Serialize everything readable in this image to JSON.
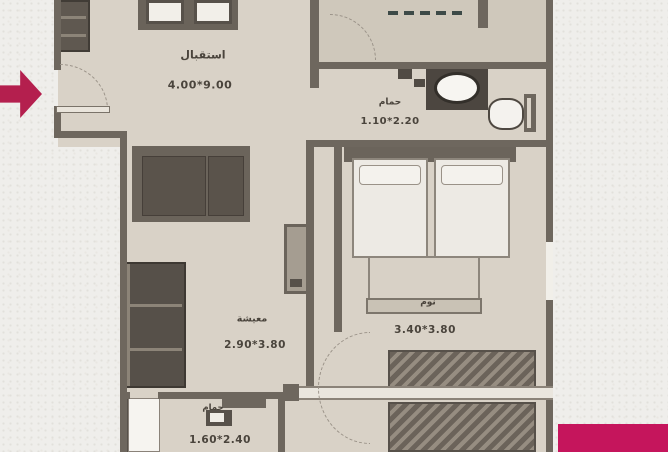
{
  "rooms": [
    {
      "key": "reception",
      "label": "استقبال",
      "dimensions": "4.00*9.00"
    },
    {
      "key": "bathroom_top",
      "label": "حمام",
      "dimensions": "1.10*2.20"
    },
    {
      "key": "bedroom",
      "label": "نوم",
      "dimensions": "3.40*3.80"
    },
    {
      "key": "living",
      "label": "معيشة",
      "dimensions": "2.90*3.80"
    },
    {
      "key": "bathroom_bottom",
      "label": "حمام",
      "dimensions": "1.60*2.40"
    }
  ],
  "colors": {
    "accent_rectangle": "#c5155c",
    "entry_arrow": "#b41f4e",
    "floor": "#d9d2c7",
    "floor_dark": "#cfc8bb",
    "wall": "#6e675e",
    "background": "#efeeeb",
    "text": "#4a443c"
  },
  "icons": {
    "entry_arrow": "arrow-right-icon"
  }
}
